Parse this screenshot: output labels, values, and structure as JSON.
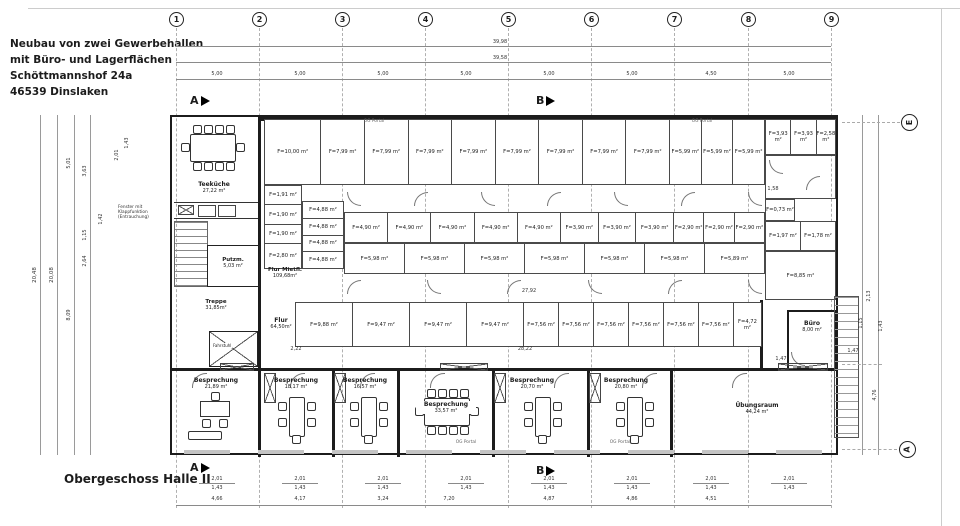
{
  "title_block": {
    "lines": [
      "Neubau von zwei Gewerbehallen",
      "mit Büro- und Lagerflächen",
      "Schöttmannshof 24a",
      "46539 Dinslaken"
    ]
  },
  "drawing_label": "Obergeschoss Halle II",
  "grid": {
    "columns": [
      "1",
      "2",
      "3",
      "4",
      "5",
      "6",
      "7",
      "8",
      "9"
    ],
    "spacings": [
      "5,00",
      "5,00",
      "5,00",
      "5,00",
      "5,00",
      "5,00",
      "4,50",
      "5,00"
    ],
    "total_outer": "39,98",
    "total_inner": "39,58",
    "row_bubble_top": "E",
    "row_bubble_bottom": "A"
  },
  "section_markers": {
    "a": "A",
    "b": "B"
  },
  "rooms": {
    "teekueche": {
      "name": "Teeküche",
      "area": "27,22 m²"
    },
    "putzraum": {
      "name": "Putzm.",
      "area": "5,03 m²"
    },
    "treppe": {
      "name": "Treppe",
      "area": "31,85m²"
    },
    "flur_mietfl": {
      "name": "Flur Mietfl.",
      "area": "109,68m²"
    },
    "flur": {
      "name": "Flur",
      "area": "64,50m²"
    },
    "buero": {
      "name": "Büro",
      "area": "8,00 m²"
    },
    "uebungsraum": {
      "name": "Übungsraum",
      "area": "44,24 m²"
    },
    "besprechung": [
      {
        "name": "Besprechung",
        "area": "21,89 m²"
      },
      {
        "name": "Besprechung",
        "area": "18,17 m²"
      },
      {
        "name": "Besprechung",
        "area": "16,57 m²"
      },
      {
        "name": "Besprechung",
        "area": "33,57 m²"
      },
      {
        "name": "Besprechung",
        "area": "20,70 m²"
      },
      {
        "name": "Besprechung",
        "area": "20,80 m²"
      }
    ]
  },
  "storage_units": {
    "row_top": [
      "F=10,00 m²",
      "F=7,99 m²",
      "F=7,99 m²",
      "F=7,99 m²",
      "F=7,99 m²",
      "F=7,99 m²",
      "F=7,99 m²",
      "F=7,99 m²",
      "F=7,99 m²",
      "F=5,99 m²",
      "F=5,99 m²",
      "F=5,99 m²"
    ],
    "corner_top": [
      "F=3,93 m²",
      "F=3,93 m²",
      "F=2,58 m²"
    ],
    "left_col_a": [
      "F=1,91 m²",
      "F=1,90 m²",
      "F=1,90 m²",
      "F=2,80 m²"
    ],
    "left_col_b": [
      "F=4,88 m²",
      "F=4,88 m²",
      "F=4,88 m²",
      "F=4,88 m²"
    ],
    "row_mid_upper": [
      "F=4,90 m²",
      "F=4,90 m²",
      "F=4,90 m²",
      "F=4,90 m²",
      "F=4,90 m²",
      "F=3,90 m²",
      "F=3,90 m²",
      "F=3,90 m²",
      "F=2,90 m²",
      "F=2,90 m²",
      "F=2,90 m²"
    ],
    "row_mid_lower": [
      "F=5,98 m²",
      "F=5,98 m²",
      "F=5,98 m²",
      "F=5,98 m²",
      "F=5,98 m²",
      "F=5,98 m²",
      "F=5,89 m²"
    ],
    "right_block": {
      "small": "F=0,73 m²",
      "pair": [
        "F=1,97 m²",
        "F=1,78 m²"
      ],
      "large": "F=8,85 m²"
    },
    "row_lower": [
      "F=9,88 m²",
      "F=9,47 m²",
      "F=9,47 m²",
      "F=9,47 m²",
      "F=7,56 m²",
      "F=7,56 m²",
      "F=7,56 m²",
      "F=7,56 m²",
      "F=7,56 m²",
      "F=7,56 m²",
      "F=4,72 m²"
    ]
  },
  "dimensions": {
    "bottom_pairs": [
      {
        "outer": "2,01",
        "inner": "1,43"
      },
      {
        "outer": "2,01",
        "inner": "1,43"
      },
      {
        "outer": "2,01",
        "inner": "1,43"
      },
      {
        "outer": "2,01",
        "inner": "1,43"
      },
      {
        "outer": "2,01",
        "inner": "1,43"
      },
      {
        "outer": "2,01",
        "inner": "1,43"
      },
      {
        "outer": "2,01",
        "inner": "1,43"
      },
      {
        "outer": "2,01",
        "inner": "1,43"
      }
    ],
    "bottom_chain": [
      "4,66",
      "4,17",
      "3,24",
      "7,20",
      "4,87",
      "4,86",
      "4,51"
    ],
    "left_labels": [
      "20,48",
      "20,08",
      "5,01",
      "3,63",
      "1,42",
      "1,15",
      "2,64",
      "8,09",
      "2,01",
      "1,43"
    ],
    "right_labels": [
      "2,13",
      "1,43",
      "1,15",
      "4,76",
      "1,47"
    ],
    "inner_labels": [
      "27,92",
      "28,22",
      "2,22",
      "1,58",
      "1,47"
    ]
  },
  "annotations": {
    "og_portal": "OG  Portal",
    "fenster_note": "Fenster mit\nKlappfunktion\n(Entrauchung)",
    "fahrstuhl": "Fahrstuhl"
  }
}
